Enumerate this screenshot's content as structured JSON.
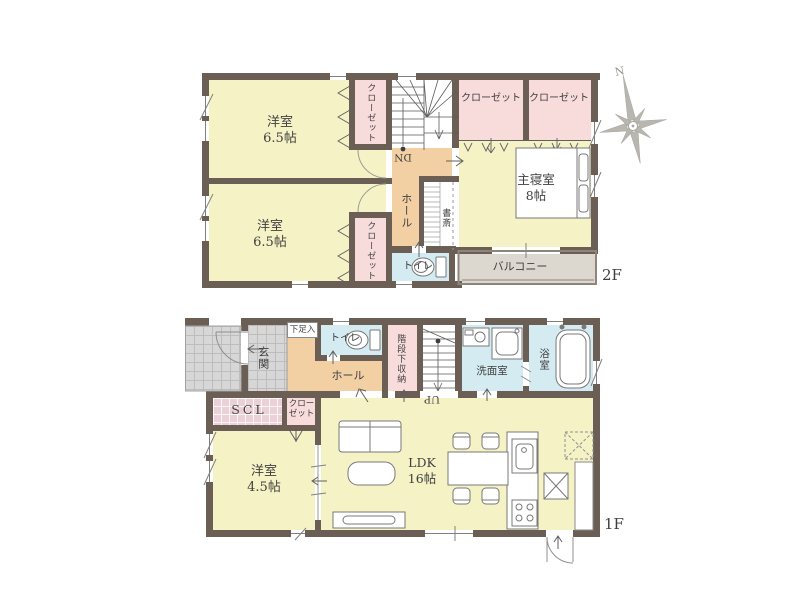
{
  "colors": {
    "wall": "#6b5f55",
    "room_yellow": "#f5f3c6",
    "closet_pink": "#f8dcdc",
    "hall_orange": "#f3d0a4",
    "wet_blue": "#d5ebf2",
    "balcony_gray": "#dcd8d0",
    "entry_tile_gray": "#d7d7d7",
    "scl_pink": "#ecd0d8"
  },
  "compass": {
    "north": "N"
  },
  "floor2": {
    "floor_label": "2F",
    "bedroom_a": {
      "name": "洋室",
      "size": "6.5帖"
    },
    "bedroom_b": {
      "name": "洋室",
      "size": "6.5帖"
    },
    "master_bedroom": {
      "name": "主寝室",
      "size": "8帖"
    },
    "closet_a": "クローゼット",
    "closet_b": "クローゼット",
    "closet_c": "クローゼット",
    "closet_d": "クローゼット",
    "hall": "ホール",
    "study": "書斎",
    "toilet": "トイレ",
    "balcony": "バルコニー",
    "stairs": "DN"
  },
  "floor1": {
    "floor_label": "1F",
    "entrance": "玄関",
    "shoe_cabinet": "下足入",
    "toilet": "トイレ",
    "hall": "ホール",
    "under_stair_storage": "階段下収納",
    "stairs": "UP",
    "washroom": "洗面室",
    "bathroom": "浴室",
    "scl": "SCL",
    "closet_line1": "クロー",
    "closet_line2": "ゼット",
    "bedroom": {
      "name": "洋室",
      "size": "4.5帖"
    },
    "ldk": {
      "name": "LDK",
      "size": "16帖"
    }
  }
}
